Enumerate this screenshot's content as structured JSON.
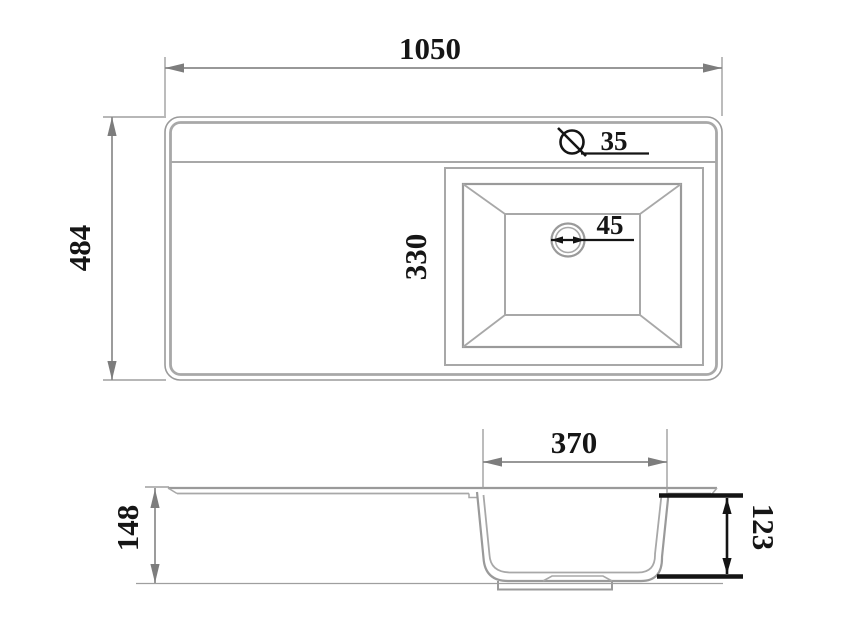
{
  "drawing": {
    "kind": "sink-dimensional-drawing",
    "views": [
      "top-view",
      "side-section-view"
    ]
  },
  "dimensions": {
    "overall_width": "1050",
    "overall_depth": "484",
    "bowl_length_top": "330",
    "drain_diameter": "45",
    "faucet_hole_diameter": "35",
    "bowl_width_side": "370",
    "overall_height": "148",
    "bowl_depth": "123"
  },
  "icons": {
    "faucet_hole_symbol": "diameter-circle-with-slash"
  },
  "colors": {
    "background": "#ffffff",
    "outline_gray": "#9a9a9a",
    "dimension_gray": "#8a8a8a",
    "emphasis_black": "#141414",
    "text": "#161616"
  }
}
